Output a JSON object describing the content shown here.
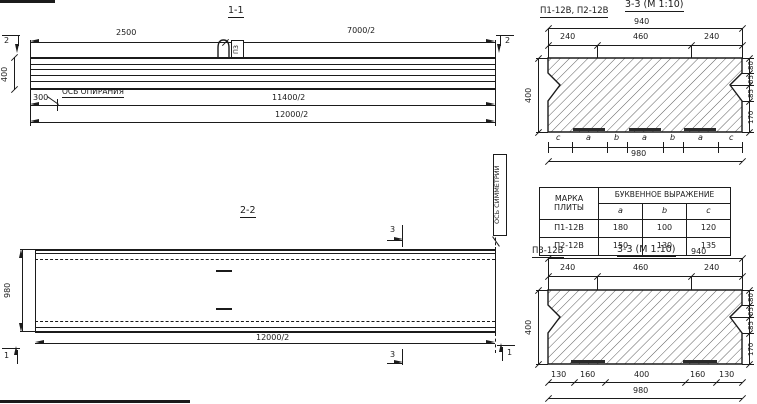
{
  "s11": {
    "title": "1-1",
    "marker2": "2",
    "d2500": "2500",
    "d7000": "7000/2",
    "d400": "400",
    "d300": "300",
    "axis_label": "ОСЬ ОПИРАНИЯ",
    "d11400": "11400/2",
    "d12000": "12000/2",
    "loop_mark": "П3"
  },
  "s22": {
    "title": "2-2",
    "marker3": "3",
    "marker1": "1",
    "d980": "980",
    "d12000": "12000/2",
    "sym_label": "ОСЬ СИММЕТРИИ"
  },
  "dtop": {
    "label": "П1-12В, П2-12В",
    "title": "3-3 (М 1:10)",
    "d940": "940",
    "d240l": "240",
    "d460": "460",
    "d240r": "240",
    "d400": "400",
    "r80": "80",
    "r65": "65",
    "r85": "85",
    "r170": "170",
    "letters": [
      "c",
      "a",
      "b",
      "a",
      "b",
      "a",
      "c"
    ],
    "d980": "980"
  },
  "dbot": {
    "label": "П3-12В",
    "title": "3-3 (М 1:10)",
    "d940": "940",
    "d240l": "240",
    "d460": "460",
    "d240r": "240",
    "d400": "400",
    "r80": "80",
    "r65": "65",
    "r85": "85",
    "r170": "170",
    "b130l": "130",
    "b160l": "160",
    "b400": "400",
    "b160r": "160",
    "b130r": "130",
    "d980": "980"
  },
  "table": {
    "h_mark": "МАРКА ПЛИТЫ",
    "h_expr": "БУКВЕННОЕ ВЫРАЖЕНИЕ",
    "cols": [
      "a",
      "b",
      "c"
    ],
    "rows": [
      {
        "mark": "П1-12В",
        "a": "180",
        "b": "100",
        "c": "120"
      },
      {
        "mark": "П2-12В",
        "a": "150",
        "b": "130",
        "c": "135"
      }
    ]
  }
}
